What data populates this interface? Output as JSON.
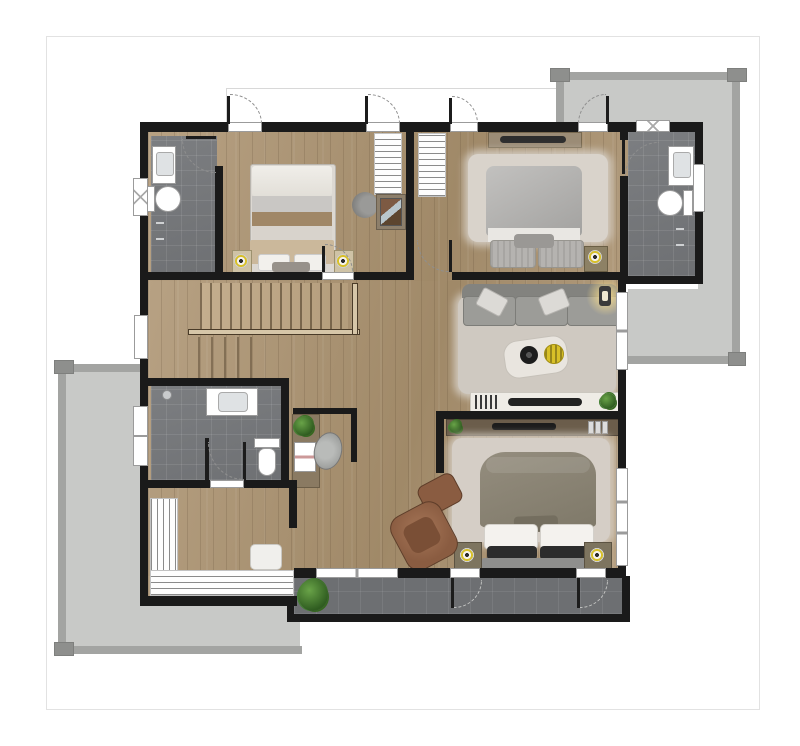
{
  "meta": {
    "description": "Rendered architectural floor plan of an upper residence level, top-down view, no text labels"
  },
  "palette": {
    "wall": "#1a1a1a",
    "wood_light": "#b7a183",
    "wood_dark": "#a08968",
    "tile_dark": "#6d6f72",
    "concrete": "#c8c9c7",
    "concrete_edge": "#a3a4a2",
    "concrete_cap": "#8e8f8d",
    "fixture_border": "#9b9b9b",
    "accent_yellow": "#d8c028",
    "plant_green": "#3f7a2c",
    "leather_brown": "#8a5c41",
    "rail_wood": "#d6c6a8",
    "page_border": "#e2e2e2"
  },
  "rooms": [
    {
      "id": "bedroom-1",
      "furniture": [
        "double-bed",
        "nightstand",
        "table-lamp",
        "wardrobe",
        "desk",
        "chair"
      ]
    },
    {
      "id": "bedroom-2",
      "furniture": [
        "double-bed",
        "area-rug",
        "tv-shelf",
        "nightstand",
        "table-lamp",
        "wardrobe"
      ]
    },
    {
      "id": "master-bedroom",
      "furniture": [
        "double-bed",
        "area-rug",
        "nightstand",
        "table-lamp",
        "tv-console",
        "armchair",
        "ottoman",
        "dressing-table",
        "stool"
      ]
    },
    {
      "id": "lounge",
      "furniture": [
        "sofa",
        "area-rug",
        "coffee-table",
        "console-table",
        "tv",
        "wall-sconce",
        "plant"
      ]
    },
    {
      "id": "bathroom-ensuite-1",
      "furniture": [
        "sink",
        "toilet",
        "window"
      ]
    },
    {
      "id": "bathroom-ensuite-2",
      "furniture": [
        "sink",
        "toilet",
        "window"
      ]
    },
    {
      "id": "bathroom-shared",
      "furniture": [
        "sink",
        "toilet",
        "shower"
      ]
    },
    {
      "id": "walk-in-closet",
      "furniture": [
        "wardrobe-rails"
      ]
    },
    {
      "id": "hall-stairs",
      "furniture": [
        "staircase",
        "railing",
        "vanity-desk",
        "chair",
        "magazine-rack"
      ]
    },
    {
      "id": "balcony-top-right",
      "furniture": []
    },
    {
      "id": "balcony-left",
      "furniture": []
    },
    {
      "id": "balcony-bottom",
      "furniture": [
        "plant"
      ]
    }
  ]
}
